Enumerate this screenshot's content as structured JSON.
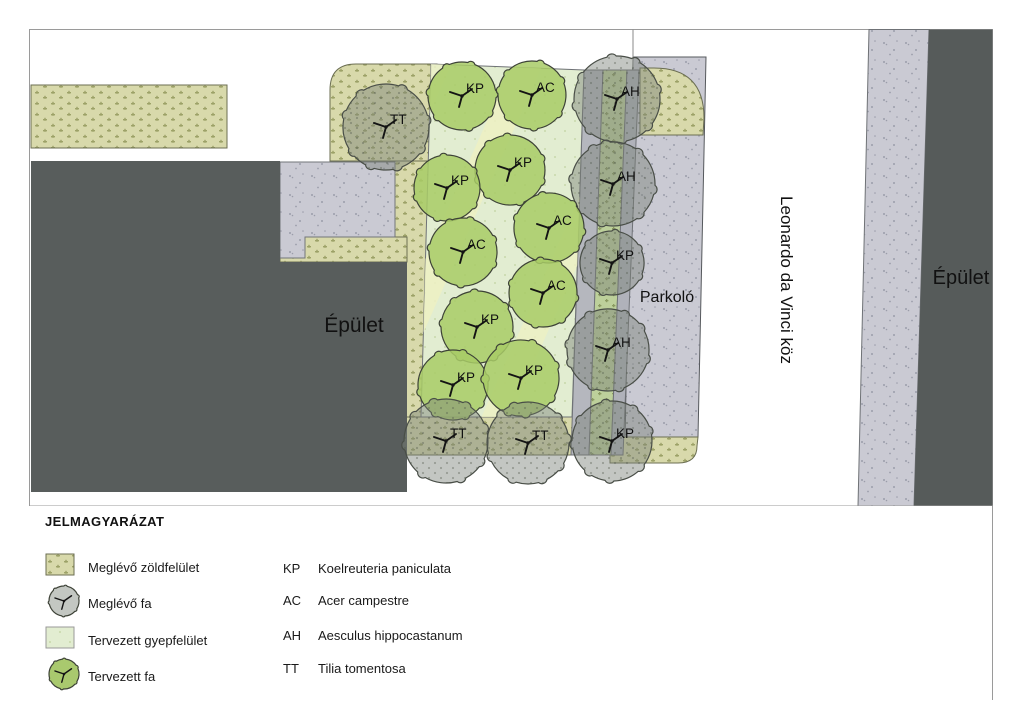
{
  "plan": {
    "building_left_label": "Épület",
    "building_right_label": "Épület",
    "parking_label": "Parkoló",
    "street_label": "Leonardo da Vinci köz",
    "trees": [
      {
        "code": "KP",
        "x": 462,
        "y": 96,
        "r": 34,
        "kind": "planned"
      },
      {
        "code": "AC",
        "x": 532,
        "y": 95,
        "r": 34,
        "kind": "planned"
      },
      {
        "code": "AH",
        "x": 617,
        "y": 99,
        "r": 43,
        "kind": "existing"
      },
      {
        "code": "TT",
        "x": 386,
        "y": 127,
        "r": 43,
        "kind": "existing"
      },
      {
        "code": "KP",
        "x": 510,
        "y": 170,
        "r": 35,
        "kind": "planned"
      },
      {
        "code": "AH",
        "x": 613,
        "y": 184,
        "r": 42,
        "kind": "existing"
      },
      {
        "code": "KP",
        "x": 447,
        "y": 188,
        "r": 33,
        "kind": "planned"
      },
      {
        "code": "AC",
        "x": 549,
        "y": 228,
        "r": 35,
        "kind": "planned"
      },
      {
        "code": "AC",
        "x": 463,
        "y": 252,
        "r": 34,
        "kind": "planned"
      },
      {
        "code": "KP",
        "x": 612,
        "y": 263,
        "r": 32,
        "kind": "existing"
      },
      {
        "code": "AC",
        "x": 543,
        "y": 293,
        "r": 34,
        "kind": "planned"
      },
      {
        "code": "KP",
        "x": 477,
        "y": 327,
        "r": 36,
        "kind": "planned"
      },
      {
        "code": "AH",
        "x": 608,
        "y": 350,
        "r": 41,
        "kind": "existing"
      },
      {
        "code": "KP",
        "x": 453,
        "y": 385,
        "r": 35,
        "kind": "planned"
      },
      {
        "code": "KP",
        "x": 521,
        "y": 378,
        "r": 38,
        "kind": "planned"
      },
      {
        "code": "TT",
        "x": 446,
        "y": 441,
        "r": 42,
        "kind": "existing"
      },
      {
        "code": "TT",
        "x": 528,
        "y": 443,
        "r": 41,
        "kind": "existing"
      },
      {
        "code": "KP",
        "x": 612,
        "y": 441,
        "r": 40,
        "kind": "existing"
      }
    ]
  },
  "legend": {
    "title": "JELMAGYARÁZAT",
    "items": [
      {
        "swatch": "existing-green",
        "label": "Meglévő zöldfelület"
      },
      {
        "swatch": "existing-tree",
        "label": "Meglévő fa"
      },
      {
        "swatch": "planned-lawn",
        "label": "Tervezett gyepfelület"
      },
      {
        "swatch": "planned-tree",
        "label": "Tervezett fa"
      }
    ],
    "species": [
      {
        "code": "KP",
        "name": "Koelreuteria paniculata"
      },
      {
        "code": "AC",
        "name": "Acer campestre"
      },
      {
        "code": "AH",
        "name": "Aesculus hippocastanum"
      },
      {
        "code": "TT",
        "name": "Tilia tomentosa"
      }
    ]
  },
  "colors": {
    "khaki": "#d8d9ab",
    "khaki_dot": "#9da268",
    "lawn": "#e2edd1",
    "lawn_stripe": "#edf0c3",
    "green_strip": "#bdd09b",
    "paving": "#cacad3",
    "building": "#585d5c",
    "gray_strip": "#b5b7be",
    "planned_tree": "#a8cb68",
    "existing_tree": "#c3c7c2",
    "outline": "#3f443a"
  }
}
